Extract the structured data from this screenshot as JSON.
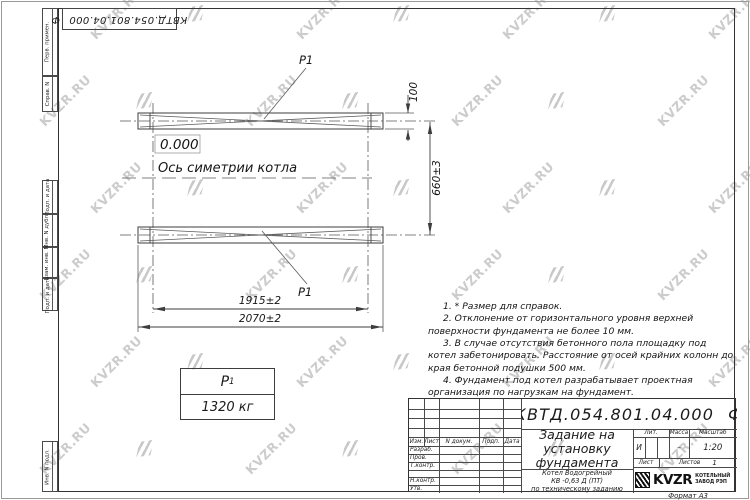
{
  "watermark": {
    "text": "KVZR.RU"
  },
  "doc": {
    "number": "КВТД.054.801.04.000",
    "suffix": "Ф"
  },
  "margin_labels": [
    "Перв. примен.",
    "Справ. N",
    "Подп. и дата",
    "Инв. N дубл.",
    "Взам. инв. N",
    "Подп. и дата",
    "Инв. N подл."
  ],
  "drawing": {
    "elevation_mark": "0.000",
    "axis_label": "Ось симетрии котла",
    "load_label": "P1",
    "dim_width_inner": "1915±2",
    "dim_width_outer": "2070±2",
    "dim_height": "660±3",
    "dim_plate": "100"
  },
  "load_table": {
    "symbol": "P",
    "symbol_sub": "1",
    "value": "1320 кг"
  },
  "notes": [
    "1. * Размер для справок.",
    "2. Отклонение от горизонтального уровня верхней поверхности фундамента не более 10 мм.",
    "3. В случае отсутствия бетонного пола площадку под котел забетонировать. Расстояние от осей крайних колонн до края бетонной подушки 500 мм.",
    "4. Фундамент под котел разрабатывает проектная организация по нагрузкам на фундамент."
  ],
  "title_block": {
    "header_cols": [
      "Изм.",
      "Лист",
      "N докум.",
      "Подп.",
      "Дата"
    ],
    "sig_rows": [
      "Разраб.",
      "Пров.",
      "Т.контр.",
      "",
      "Н.контр.",
      "Утв."
    ],
    "title_lines": [
      "Задание на",
      "установку",
      "фундамента"
    ],
    "product_lines": [
      "Котел Водогрейный",
      "КВ -0,63 Д  (ПТ)",
      "по техническому заданию"
    ],
    "lit_label": "Лит.",
    "lit_value": "И",
    "mass_label": "Масса",
    "mass_value": "–",
    "scale_label": "Масштаб",
    "scale_value": "1:20",
    "sheet_label": "Лист",
    "sheets_label": "Листов",
    "sheets_value": "1",
    "company": {
      "logo_text": "KVZR",
      "name_line1": "КОТЕЛЬНЫЙ",
      "name_line2": "ЗАВОД РЭП"
    },
    "format_label": "Формат А3"
  }
}
